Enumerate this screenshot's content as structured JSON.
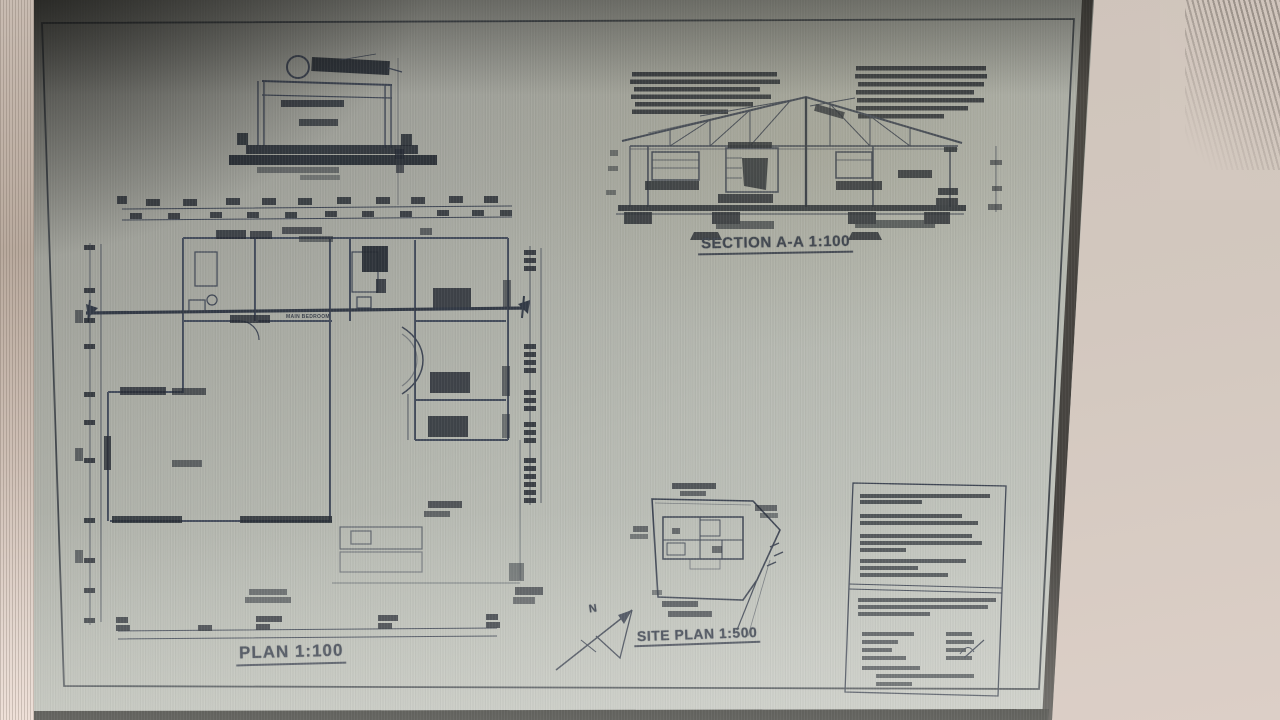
{
  "labels": {
    "section": "SECTION A-A 1:100",
    "plan": "PLAN 1:100",
    "site_plan": "SITE PLAN 1:500",
    "north": "N",
    "main_bedroom": "MAIN BEDROOM"
  },
  "drawings": [
    {
      "name": "tank-detail",
      "scale_label": ""
    },
    {
      "name": "floor-plan",
      "scale_label": "PLAN 1:100"
    },
    {
      "name": "section-a-a",
      "scale_label": "SECTION A-A 1:100"
    },
    {
      "name": "site-plan",
      "scale_label": "SITE PLAN 1:500"
    }
  ],
  "colors": {
    "ink": "#3f4654",
    "ink_dark": "#262b33",
    "paper": "#b7bab2",
    "photo_shadow": "#3c3c38",
    "wall_right": "#d3c8bf",
    "left_strip": "#c9bcb2",
    "sheet_edge": "#474440"
  }
}
